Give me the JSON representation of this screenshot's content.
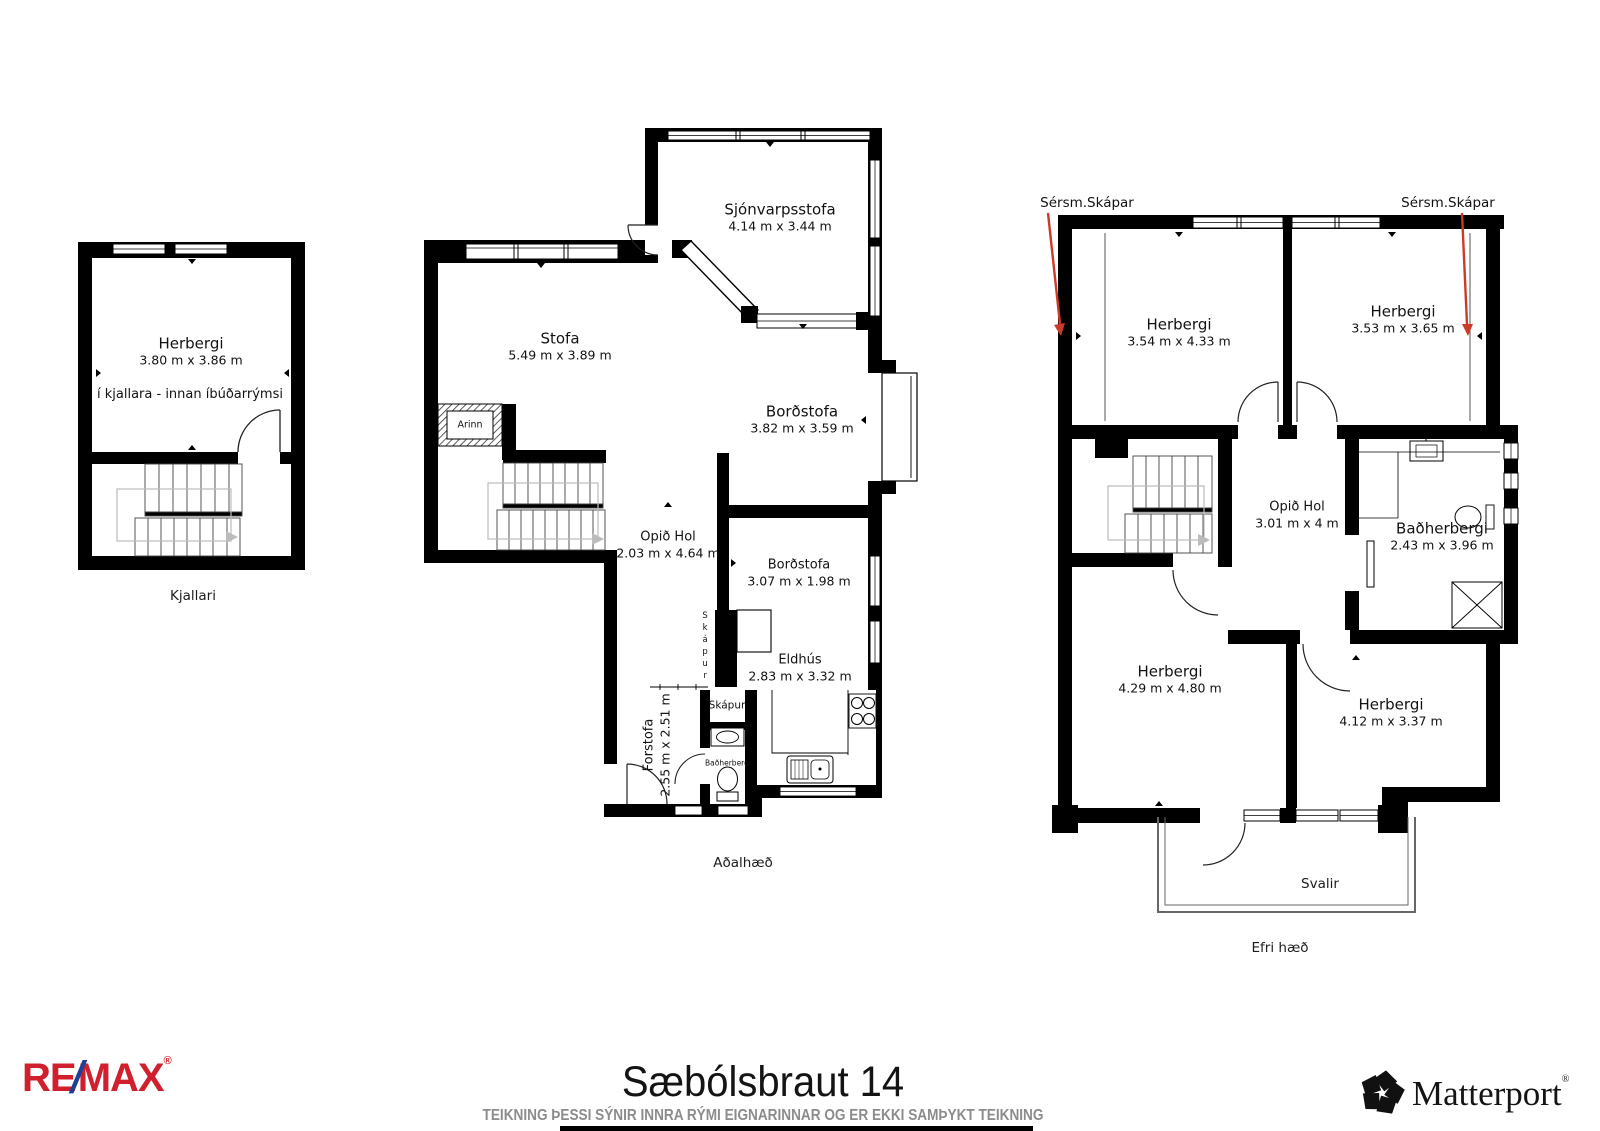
{
  "floors": {
    "kjallari": {
      "floor_label": "Kjallari",
      "herbergi": {
        "name": "Herbergi",
        "dims": "3.80 m x 3.86 m"
      },
      "note": "í kjallara - innan íbúðarrýmsi"
    },
    "adalhaed": {
      "floor_label": "Aðalhæð",
      "sjonvarpsstofa": {
        "name": "Sjónvarpsstofa",
        "dims": "4.14 m x 3.44 m"
      },
      "stofa": {
        "name": "Stofa",
        "dims": "5.49 m x 3.89 m"
      },
      "bordstofa": {
        "name": "Borðstofa",
        "dims": "3.82 m x 3.59 m"
      },
      "opid_hol": {
        "name": "Opið Hol",
        "dims": "2.03 m x 4.64 m"
      },
      "bordstofa2": {
        "name": "Borðstofa",
        "dims": "3.07 m x 1.98 m"
      },
      "eldhus": {
        "name": "Eldhús",
        "dims": "2.83 m x 3.32 m"
      },
      "forstofa": {
        "name": "Forstofa",
        "dims": "2.55 m x 2.51 m"
      },
      "skapur_tall": "Skápur",
      "skapur_box": "Skápur",
      "badherbergi": "Baðherbergi",
      "arinn": "Arinn"
    },
    "efri_haed": {
      "floor_label": "Efri hæð",
      "sersm_skapar_left": "Sérsm.Skápar",
      "sersm_skapar_right": "Sérsm.Skápar",
      "herbergi_nw": {
        "name": "Herbergi",
        "dims": "3.54 m x 4.33 m"
      },
      "herbergi_ne": {
        "name": "Herbergi",
        "dims": "3.53 m x 3.65 m"
      },
      "opid_hol": {
        "name": "Opið Hol",
        "dims": "3.01 m x 4 m"
      },
      "badherbergi": {
        "name": "Baðherbergi",
        "dims": "2.43 m x 3.96 m"
      },
      "herbergi_sw": {
        "name": "Herbergi",
        "dims": "4.29 m x 4.80 m"
      },
      "herbergi_se": {
        "name": "Herbergi",
        "dims": "4.12 m x 3.37 m"
      },
      "svalir": "Svalir"
    }
  },
  "footer": {
    "title": "Sæbólsbraut 14",
    "disclaimer": "TEIKNING ÞESSI SÝNIR INNRA RÝMI EIGNARINNAR OG ER EKKI SAMÞYKT TEIKNING",
    "remax_re": "RE",
    "remax_slash": "/",
    "remax_max": "MAX",
    "remax_reg": "®",
    "matterport": "Matterport",
    "matterport_reg": "®"
  },
  "colors": {
    "wall": "#000000",
    "closet_arrow_red": "#cc3b28",
    "disclaimer_gray": "#8c8c8c",
    "remax_red": "#d0202e",
    "remax_blue": "#1d3f94"
  }
}
